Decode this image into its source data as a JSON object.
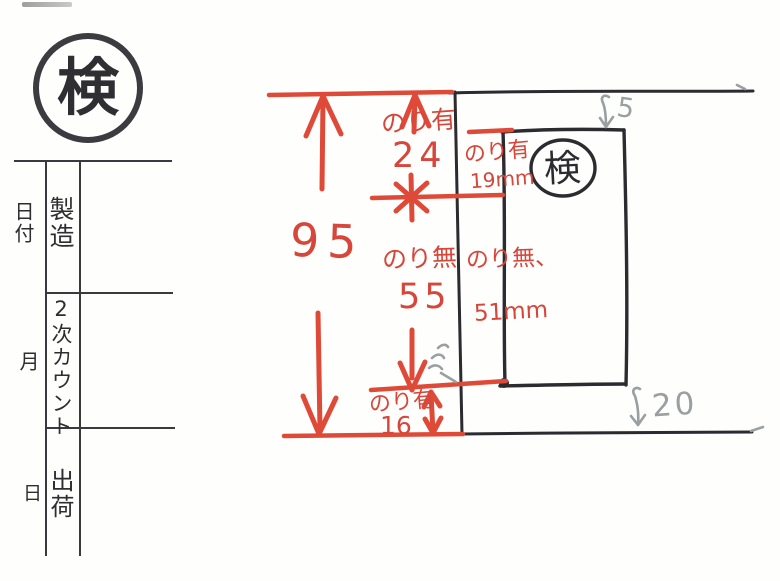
{
  "stamp": {
    "label": "検"
  },
  "table": {
    "rows": [
      {
        "outer": "日付",
        "inner": "製造"
      },
      {
        "outer": "月",
        "inner": "2次カウント"
      },
      {
        "outer": "日",
        "inner": "出荷"
      }
    ]
  },
  "diagram": {
    "stamp_label": "検",
    "total_height": "95",
    "glue_top": {
      "label": "のり有",
      "value": "24"
    },
    "glue_right": {
      "label": "のり有",
      "value": "19mm"
    },
    "no_glue_left": {
      "label": "のり無",
      "value": "55"
    },
    "no_glue_right": {
      "label": "のり無、",
      "value": "51mm"
    },
    "glue_bottom": {
      "label": "のり有",
      "value": "16"
    },
    "pencil_gap_top": "5",
    "pencil_gap_bottom": "20",
    "colors": {
      "red": "#d6463b",
      "ink": "#2b2b30",
      "pencil": "#9aa0a2"
    }
  }
}
